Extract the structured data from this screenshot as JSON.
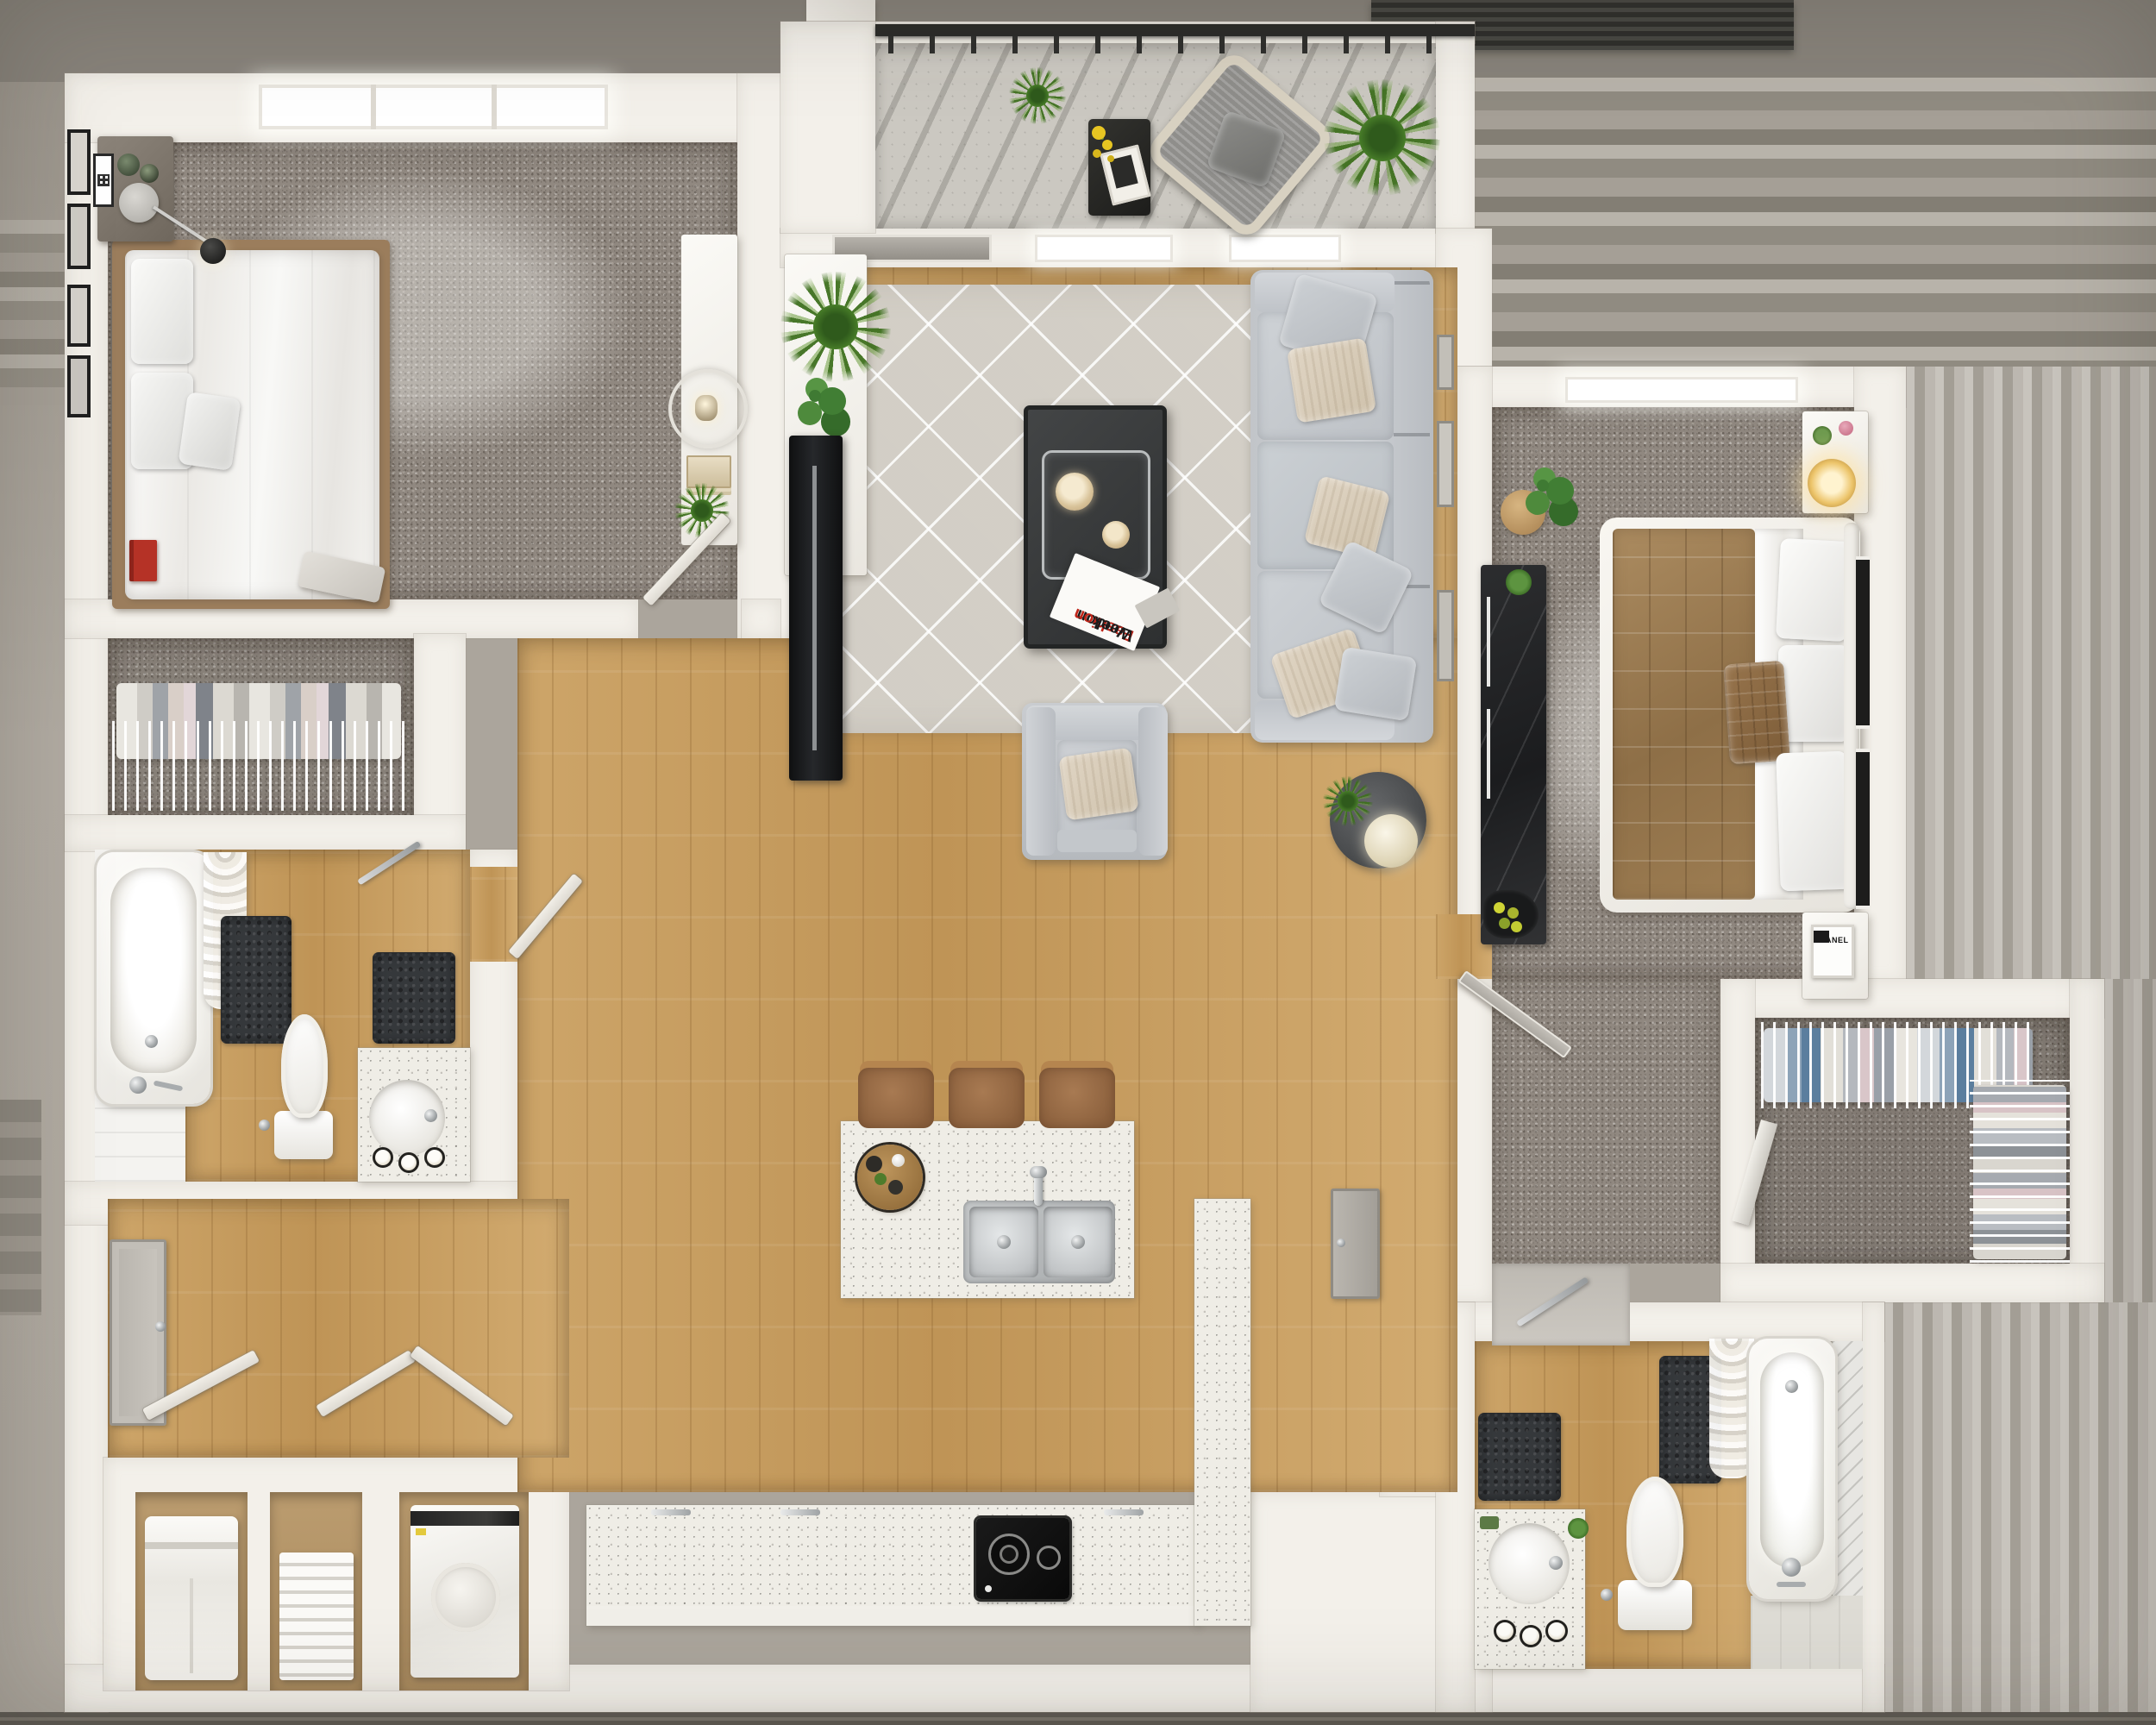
{
  "scene": {
    "kind": "3d_floor_plan_top_down_render",
    "summary": "Two-bedroom two-bath apartment with open living/kitchen, balcony, two closets and laundry nooks"
  },
  "visible_text": {
    "magazine_line1": "London",
    "magazine_line2": "Fashion",
    "magazine_line3": "Week",
    "bedroom2_frame_label": "CHANEL"
  },
  "palette": {
    "wall": "#f3f0ea",
    "carpet": "#908880",
    "wood_floor": "#c79f66",
    "balcony_concrete": "#cbc8c1",
    "area_rug": "#dcd8d0",
    "counter_speckle": "#efede6",
    "bath_mat": "#35383b",
    "sofa_fabric": "#c6c9cd",
    "bed2_quilt": "#9b7b55",
    "stool_leather": "#9c6f4a",
    "plant_green": "#477c28",
    "tv_black": "#17181a",
    "railing_black": "#2a2a28",
    "accent_red_book": "#b53226",
    "lamp_glow": "#f0c36a",
    "background_stripes": "#a39e95"
  },
  "rooms": [
    {
      "name": "bedroom-1",
      "floor": "carpet"
    },
    {
      "name": "balcony",
      "floor": "concrete"
    },
    {
      "name": "living-room",
      "floor": "wood-with-rug"
    },
    {
      "name": "bedroom-2",
      "floor": "carpet"
    },
    {
      "name": "closet-1",
      "floor": "carpet"
    },
    {
      "name": "bathroom-1",
      "floor": "wood"
    },
    {
      "name": "kitchen-dining",
      "floor": "wood"
    },
    {
      "name": "entry-hall-laundry",
      "floor": "wood"
    },
    {
      "name": "walk-in-closet",
      "floor": "carpet"
    },
    {
      "name": "bathroom-2",
      "floor": "wood"
    }
  ],
  "furniture": {
    "bedroom_1": [
      "double-bed-white",
      "nightstand",
      "ball-lamp",
      "wall-art-frames",
      "console-with-ring-lamp",
      "bench",
      "red-book"
    ],
    "living_room": [
      "sectional-sofa",
      "coffee-table-with-tray",
      "magazine",
      "armchair",
      "round-side-table",
      "tv-media-console",
      "plants"
    ],
    "balcony": [
      "rope-lounge-chair",
      "black-side-table",
      "grass-plants",
      "railing"
    ],
    "bedroom_2": [
      "double-bed-brown-quilt",
      "two-nightstands",
      "glowing-lamp",
      "dark-dresser",
      "monstera-plant"
    ],
    "kitchen": [
      "island-double-sink",
      "three-bar-stools",
      "l-counter-with-cooktop",
      "wood-serving-tray"
    ],
    "bathrooms": [
      "tub-with-curtain",
      "toilet",
      "round-sink-vanity",
      "dark-mats",
      "candles"
    ],
    "laundry": [
      "stacked-laundry-unit",
      "shelf-stack",
      "top-load-washer",
      "bifold-doors"
    ],
    "closets": [
      "wire-shelving-hanging-clothes",
      "folded-clothes-racks",
      "leaning-board"
    ]
  }
}
